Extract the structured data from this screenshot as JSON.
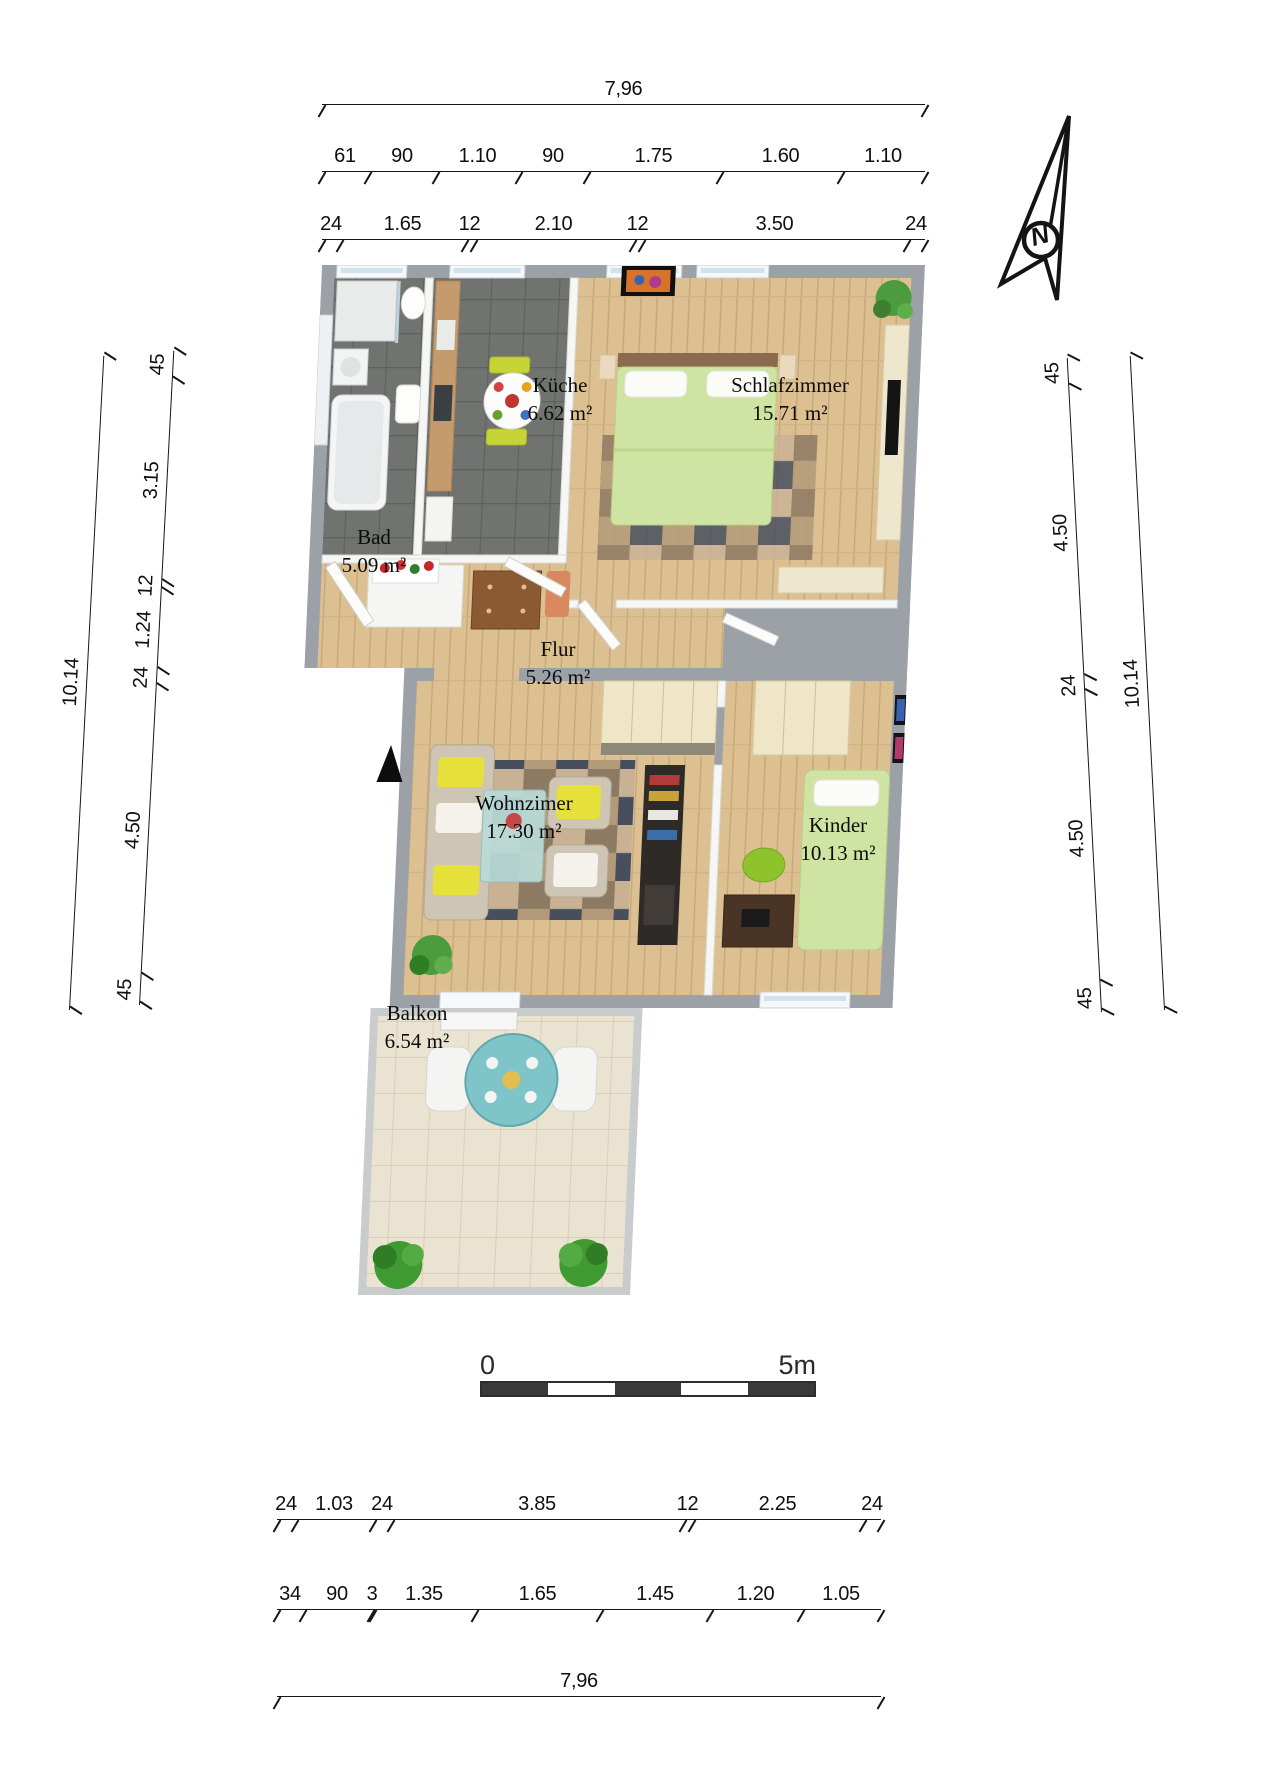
{
  "north": {
    "label": "N"
  },
  "scale_bar": {
    "start": "0",
    "end": "5m"
  },
  "rooms": [
    {
      "name": "Küche",
      "area": "6.62 m²"
    },
    {
      "name": "Schlafzimmer",
      "area": "15.71 m²"
    },
    {
      "name": "Bad",
      "area": "5.09 m²"
    },
    {
      "name": "Flur",
      "area": "5.26 m²"
    },
    {
      "name": "Wohnzimer",
      "area": "17.30 m²"
    },
    {
      "name": "Kinder",
      "area": "10.13 m²"
    },
    {
      "name": "Balkon",
      "area": "6.54 m²"
    }
  ],
  "dims": {
    "top_overall": "7,96",
    "top_row2": [
      "61",
      "90",
      "1.10",
      "90",
      "1.75",
      "1.60",
      "1.10"
    ],
    "top_row3": [
      "24",
      "1.65",
      "12",
      "2.10",
      "12",
      "3.50",
      "24"
    ],
    "left_overall": "10.14",
    "left_segments": [
      "45",
      "3.15",
      "12",
      "1.24",
      "24",
      "4.50",
      "45"
    ],
    "right_overall": "10.14",
    "right_segments": [
      "45",
      "4.50",
      "24",
      "4.50",
      "45"
    ],
    "bottom_row1": [
      "24",
      "1.03",
      "24",
      "3.85",
      "12",
      "2.25",
      "24"
    ],
    "bottom_row2": [
      "34",
      "90",
      "3",
      "1.35",
      "1.65",
      "1.45",
      "1.20",
      "1.05"
    ],
    "bottom_overall": "7,96"
  },
  "colors": {
    "outer_wall": "#9ba1a7",
    "wood_floor": "#dcc092",
    "dark_tile": "#70736f",
    "balcony_tile": "#eae3d2",
    "bed_green": "#cfe4a2",
    "chair_lime": "#c6d438",
    "plant_green": "#4c9b3e",
    "table_teal": "#7fc4c9"
  }
}
